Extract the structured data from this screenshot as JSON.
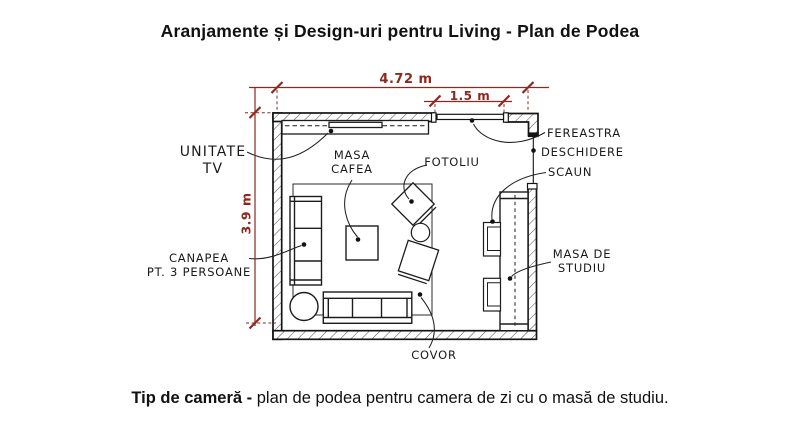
{
  "title": "Aranjamente și Design-uri pentru Living - Plan de Podea",
  "caption": {
    "lead": "Tip de cameră - ",
    "text": "plan de podea pentru camera de zi cu o masă de studiu."
  },
  "dimensions": {
    "room_width": "4.72 m",
    "window_width": "1.5 m",
    "room_depth": "3.9 m"
  },
  "labels": {
    "tv_unit": {
      "line1": "UNITATE",
      "line2": "TV"
    },
    "coffee_table": {
      "line1": "MASA",
      "line2": "CAFEA"
    },
    "armchair": "FOTOLIU",
    "window": "FEREASTRA",
    "opening": "DESCHIDERE",
    "chair": "SCAUN",
    "study_table": {
      "line1": "MASA DE",
      "line2": "STUDIU"
    },
    "sofa": {
      "line1": "CANAPEA",
      "line2": "PT. 3 PERSOANE"
    },
    "carpet": "COVOR"
  },
  "colors": {
    "dimension_red": "#8f271e",
    "line_black": "#1a1a1a"
  }
}
